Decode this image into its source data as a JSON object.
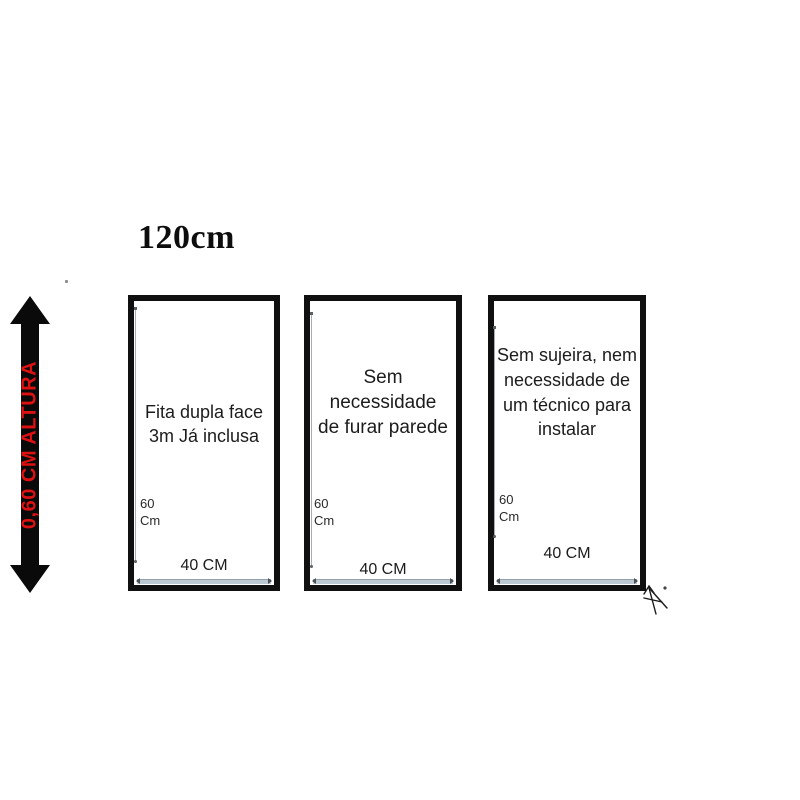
{
  "title": "120cm",
  "height_arrow": {
    "label": "0,60 CM ALTURA",
    "text_color": "#dd1111",
    "arrow_color": "#0a0a0a"
  },
  "panels": [
    {
      "lines": [
        "Fita dupla face",
        "3m Já inclusa"
      ],
      "height_label_lines": [
        "60",
        "Cm"
      ],
      "width_label": "40 CM"
    },
    {
      "lines": [
        "Sem necessidade",
        "de furar parede"
      ],
      "height_label_lines": [
        "60",
        "Cm"
      ],
      "width_label": "40 CM"
    },
    {
      "lines": [
        "Sem sujeira, nem",
        "necessidade de",
        "um técnico para",
        "instalar"
      ],
      "height_label_lines": [
        "60",
        "Cm"
      ],
      "width_label": "40 CM"
    }
  ],
  "colors": {
    "panel_border": "#101010",
    "measure_line": "#a7adb3",
    "measure_bar": "#bcc9d3",
    "text": "#1c1c1c"
  }
}
